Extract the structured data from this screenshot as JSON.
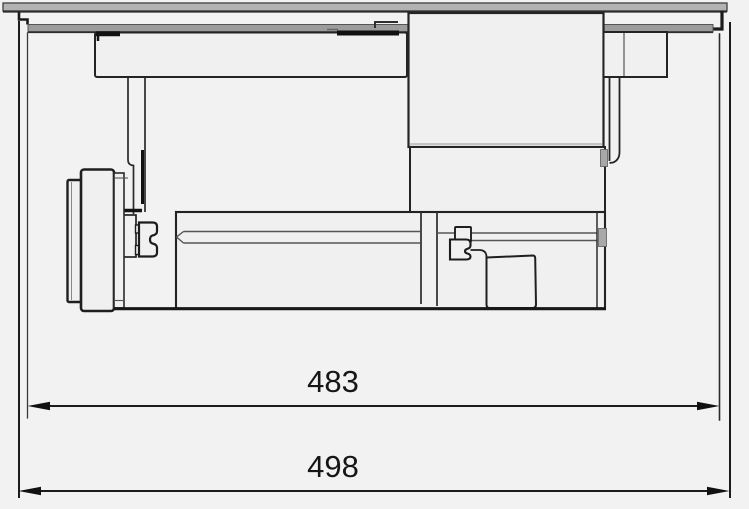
{
  "diagram": {
    "type": "technical-elevation-drawing",
    "dimension_labels": {
      "inner": "483",
      "outer": "498"
    },
    "colors": {
      "background": "#f2f2f2",
      "panel_fill": "#f0f0f0",
      "glass_fill": "#b2b2b2",
      "trim_fill": "#9c9c9c",
      "outline": "#242424",
      "detail_line": "#555555",
      "dark_line": "#141414",
      "dim_line": "#1d1d1d",
      "dim_text": "#161616",
      "metal_fill": "#a8a8a8"
    }
  }
}
